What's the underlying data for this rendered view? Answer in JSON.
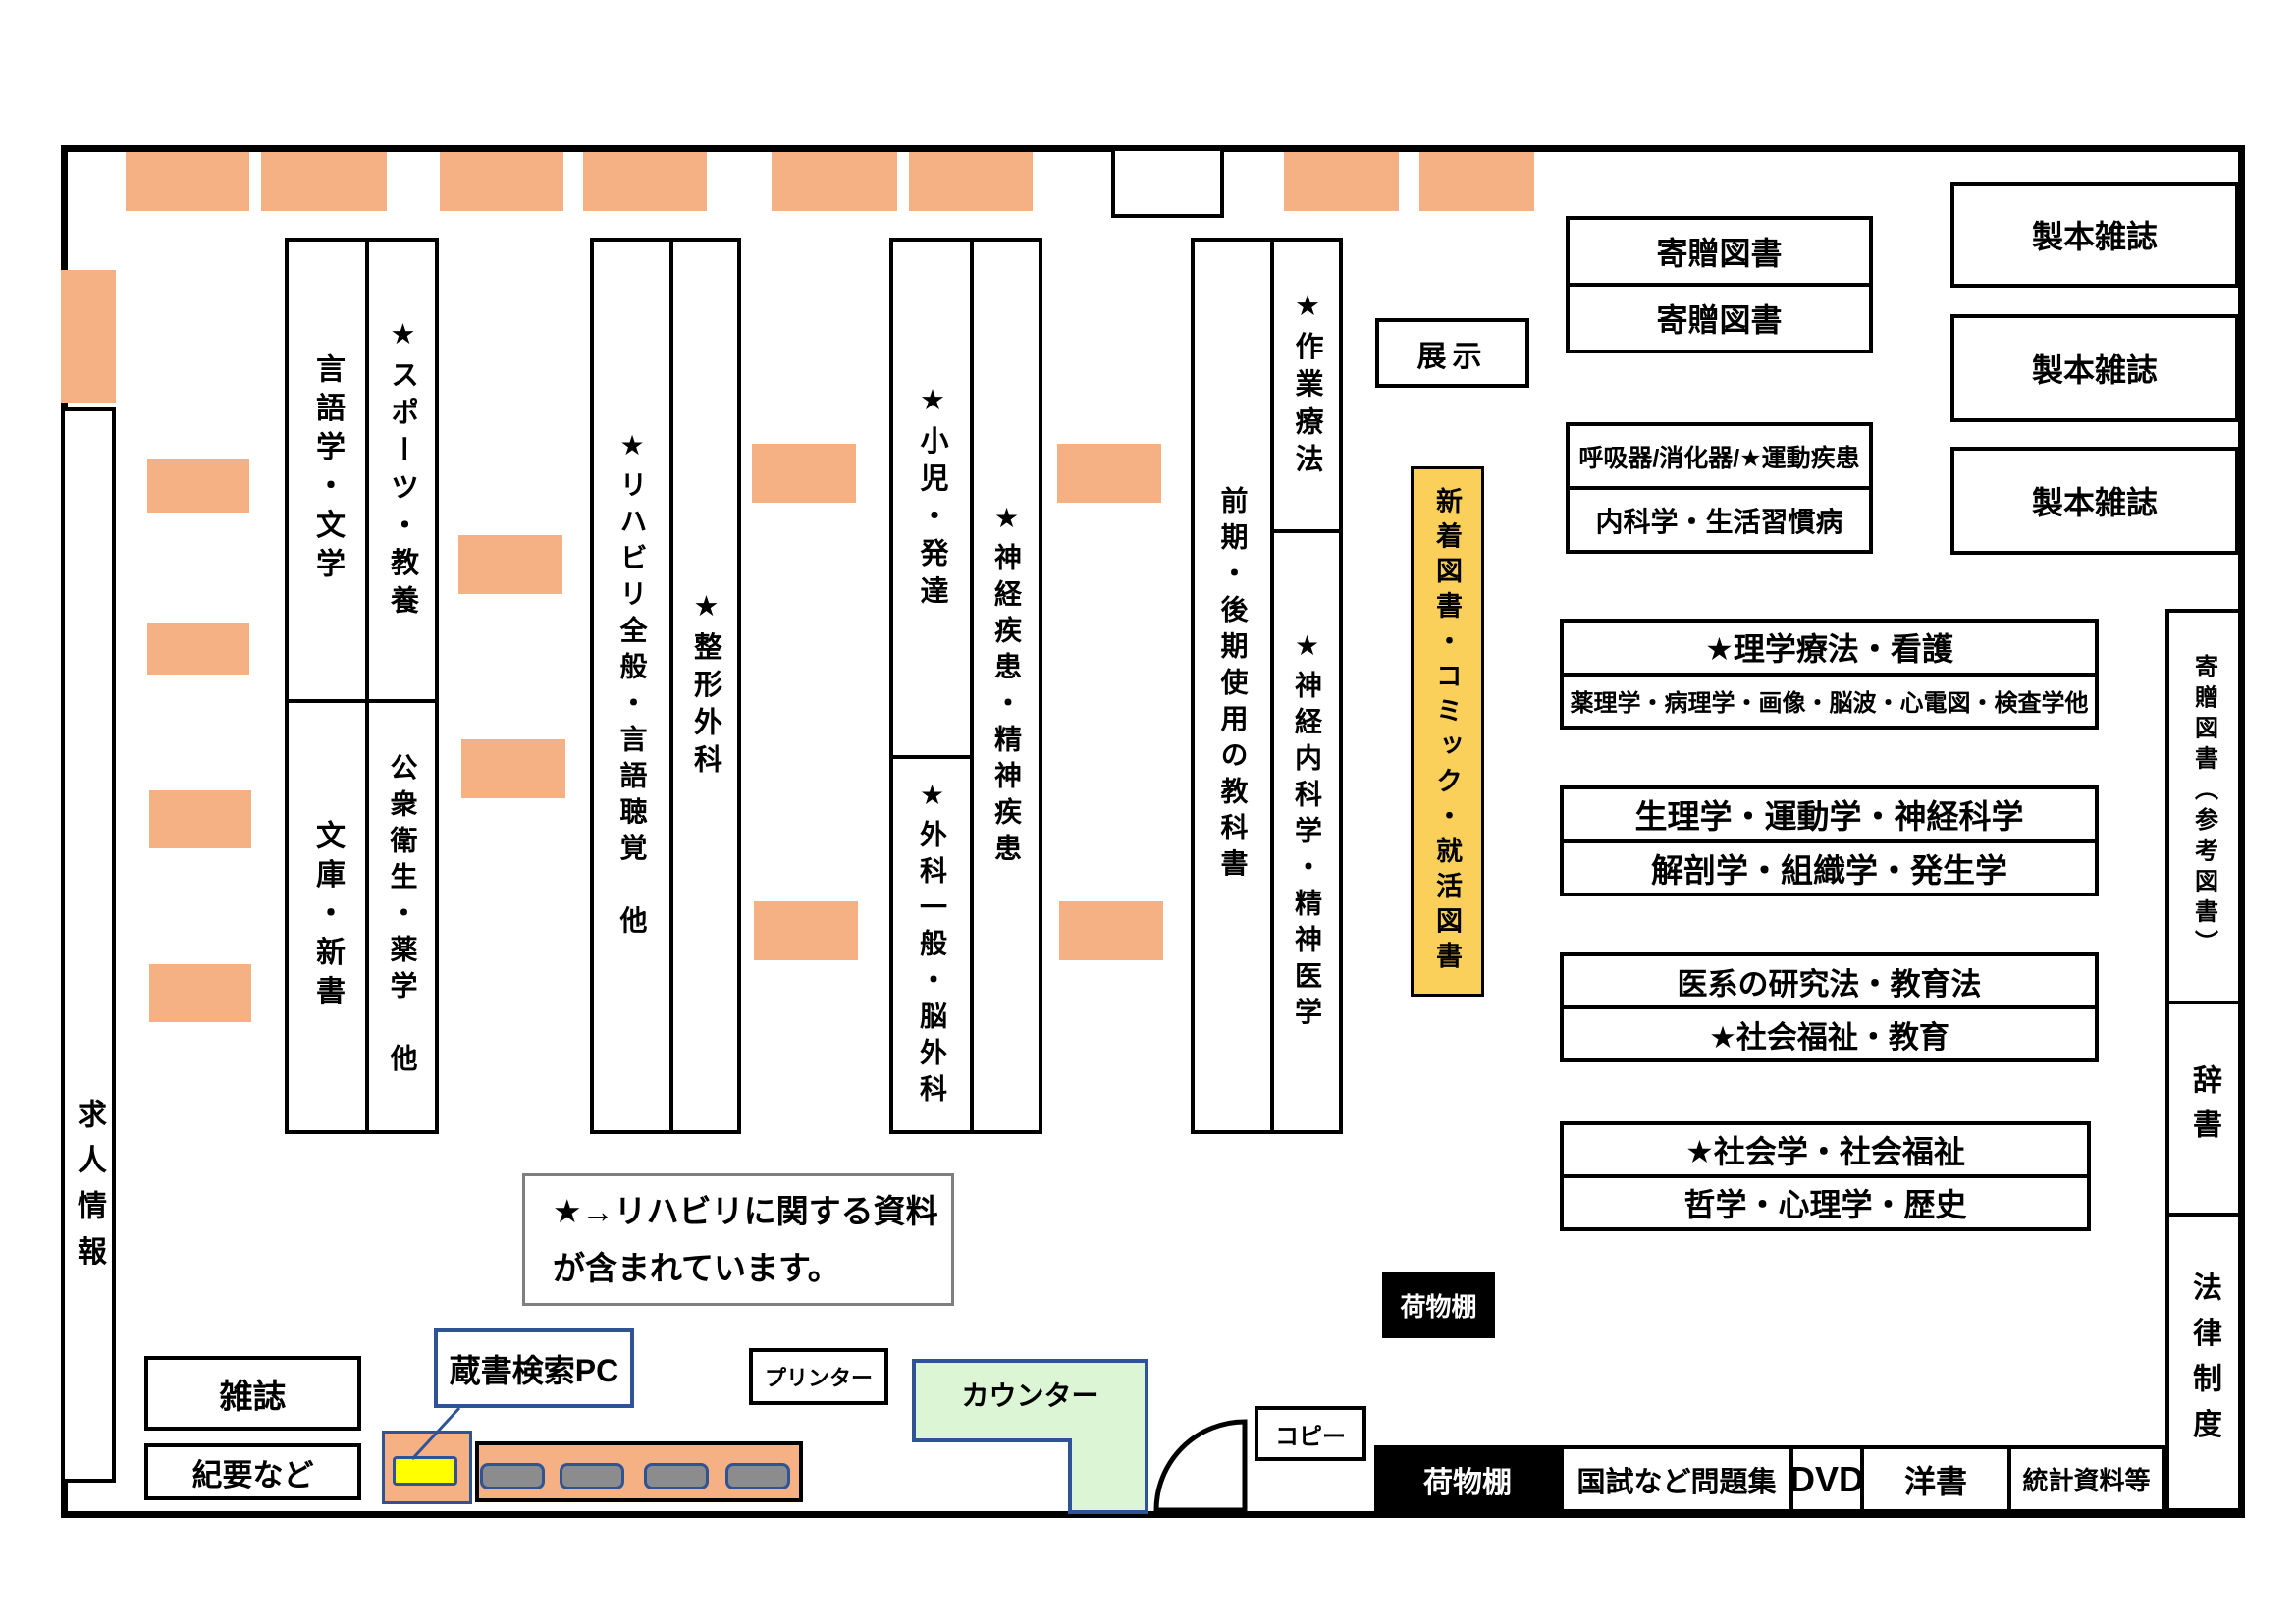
{
  "title": "図書館フロアマップ",
  "colors": {
    "desk_orange": "#F5B183",
    "accent_navy": "#2F5496",
    "new_books_yellow": "#FAD05A",
    "counter_green": "#DCF5D4",
    "pc_yellow": "#FFFF00",
    "monitor_gray": "#8C8C8C",
    "note_gray": "#7F7F7F"
  },
  "shelves": {
    "job_info": "求人情報",
    "block_a": {
      "top_left": "言語学・文学",
      "top_right": "★スポーツ・教養",
      "bottom_left": "文庫・新書",
      "bottom_right": "公衆衛生・薬学　他"
    },
    "block_b": {
      "left": "★リハビリ全般・言語聴覚　他",
      "right": "★整形外科"
    },
    "block_c": {
      "top_left": "★小児・発達",
      "bottom_left": "★外科一般・脳外科",
      "right": "★神経疾患・精神疾患"
    },
    "block_d": {
      "left": "前期・後期使用の教科書",
      "top_right": "★作業療法",
      "bottom_right": "★神経内科学・精神医学"
    }
  },
  "center": {
    "exhibit": "展示",
    "new_books": "新着図書・コミック・就活図書"
  },
  "right_side": {
    "donated_top": "寄贈図書",
    "donated_bottom": "寄贈図書",
    "bound_journals": [
      "製本雑誌",
      "製本雑誌",
      "製本雑誌"
    ],
    "respiratory": "呼吸器/消化器/★運動疾患",
    "internal_medicine": "内科学・生活習慣病",
    "pt_nursing": "★理学療法・看護",
    "pharmacology": "薬理学・病理学・画像・脳波・心電図・検査学他",
    "physiology": "生理学・運動学・神経科学",
    "anatomy": "解剖学・組織学・発生学",
    "research": "医系の研究法・教育法",
    "welfare_edu": "★社会福祉・教育",
    "sociology": "★社会学・社会福祉",
    "philosophy": "哲学・心理学・歴史",
    "donated_ref": "寄贈図書（参考図書）",
    "dictionary": "辞書",
    "law": "法律制度"
  },
  "bottom": {
    "luggage_upper": "荷物棚",
    "luggage_lower": "荷物棚",
    "exam_books": "国試など問題集",
    "dvd": "DVD",
    "western_books": "洋書",
    "statistics": "統計資料等",
    "magazines": "雑誌",
    "bulletins": "紀要など",
    "opac": "蔵書検索PC",
    "printer": "プリンター",
    "counter": "カウンター",
    "copy": "コピー"
  },
  "note": {
    "line1": "★→リハビリに関する資料",
    "line2": "が含まれています。"
  }
}
